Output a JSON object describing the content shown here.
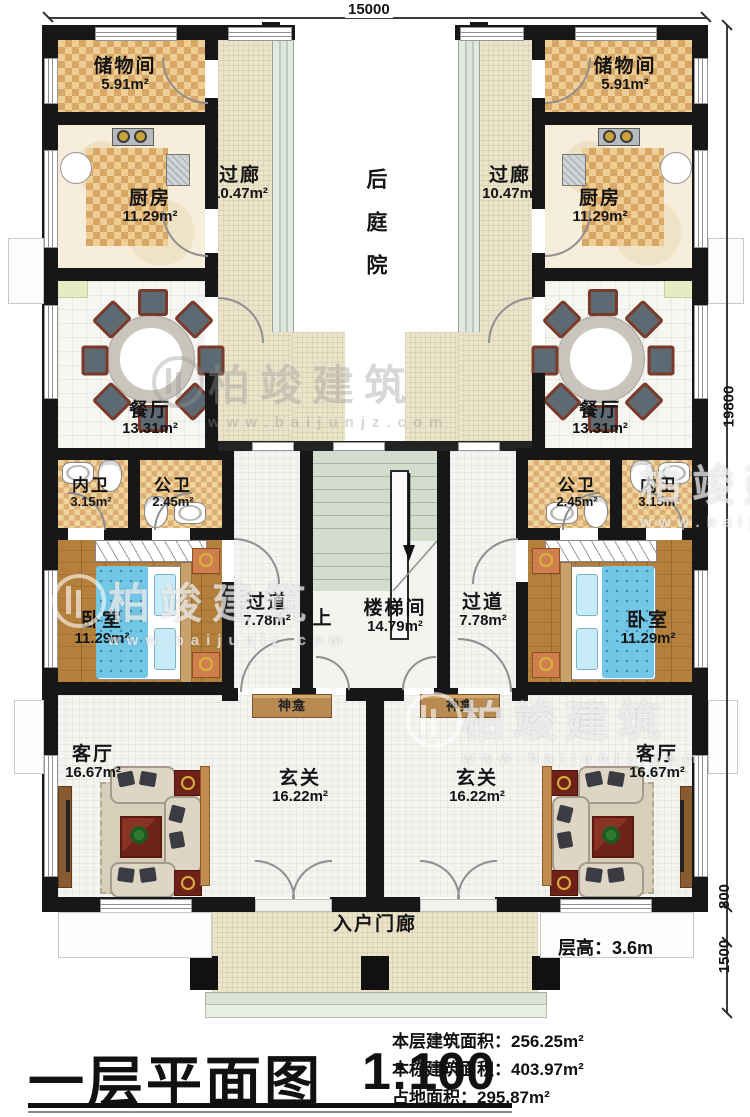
{
  "plan": {
    "dim_top": "15000",
    "dim_right": "19800",
    "dim_step": "800",
    "dim_porch": "1500"
  },
  "rooms": {
    "storage": {
      "name": "储物间",
      "area": "5.91m²"
    },
    "kitchen": {
      "name": "厨房",
      "area": "11.29m²"
    },
    "corridor": {
      "name": "过廊",
      "area": "10.47m²"
    },
    "courtyard": {
      "name": "后庭院"
    },
    "dining": {
      "name": "餐厅",
      "area": "13.31m²"
    },
    "bath_inner": {
      "name": "内卫",
      "area": "3.15m²"
    },
    "bath_public": {
      "name": "公卫",
      "area": "2.45m²"
    },
    "bedroom": {
      "name": "卧室",
      "area": "11.29m²"
    },
    "hallway": {
      "name": "过道",
      "area": "7.78m²"
    },
    "stairwell": {
      "name": "楼梯间",
      "area": "14.79m²",
      "up": "上"
    },
    "shrine": {
      "name": "神龛"
    },
    "living": {
      "name": "客厅",
      "area": "16.67m²"
    },
    "foyer": {
      "name": "玄关",
      "area": "16.22m²"
    },
    "porch": {
      "name": "入户门廊"
    }
  },
  "notes": {
    "floor_height_label": "层高：",
    "floor_height_value": "3.6m"
  },
  "title_block": {
    "title": "一层平面图",
    "scale": "1:100",
    "areas": [
      {
        "label": "本层建筑面积：",
        "value": "256.25m²"
      },
      {
        "label": "本栋建筑面积：",
        "value": "403.97m²"
      },
      {
        "label": "占地面积：",
        "value": "295.87m²"
      }
    ]
  },
  "watermark": {
    "brand": "柏竣建筑",
    "url": "www.baijunjz.com"
  },
  "colors": {
    "wall": "#171717",
    "checker_floor": "#d9a765",
    "corridor_floor": "#ece4c9",
    "wood_floor": "#b5803c",
    "bed": "#72c6e6",
    "stairs": "#c9d4c2"
  }
}
